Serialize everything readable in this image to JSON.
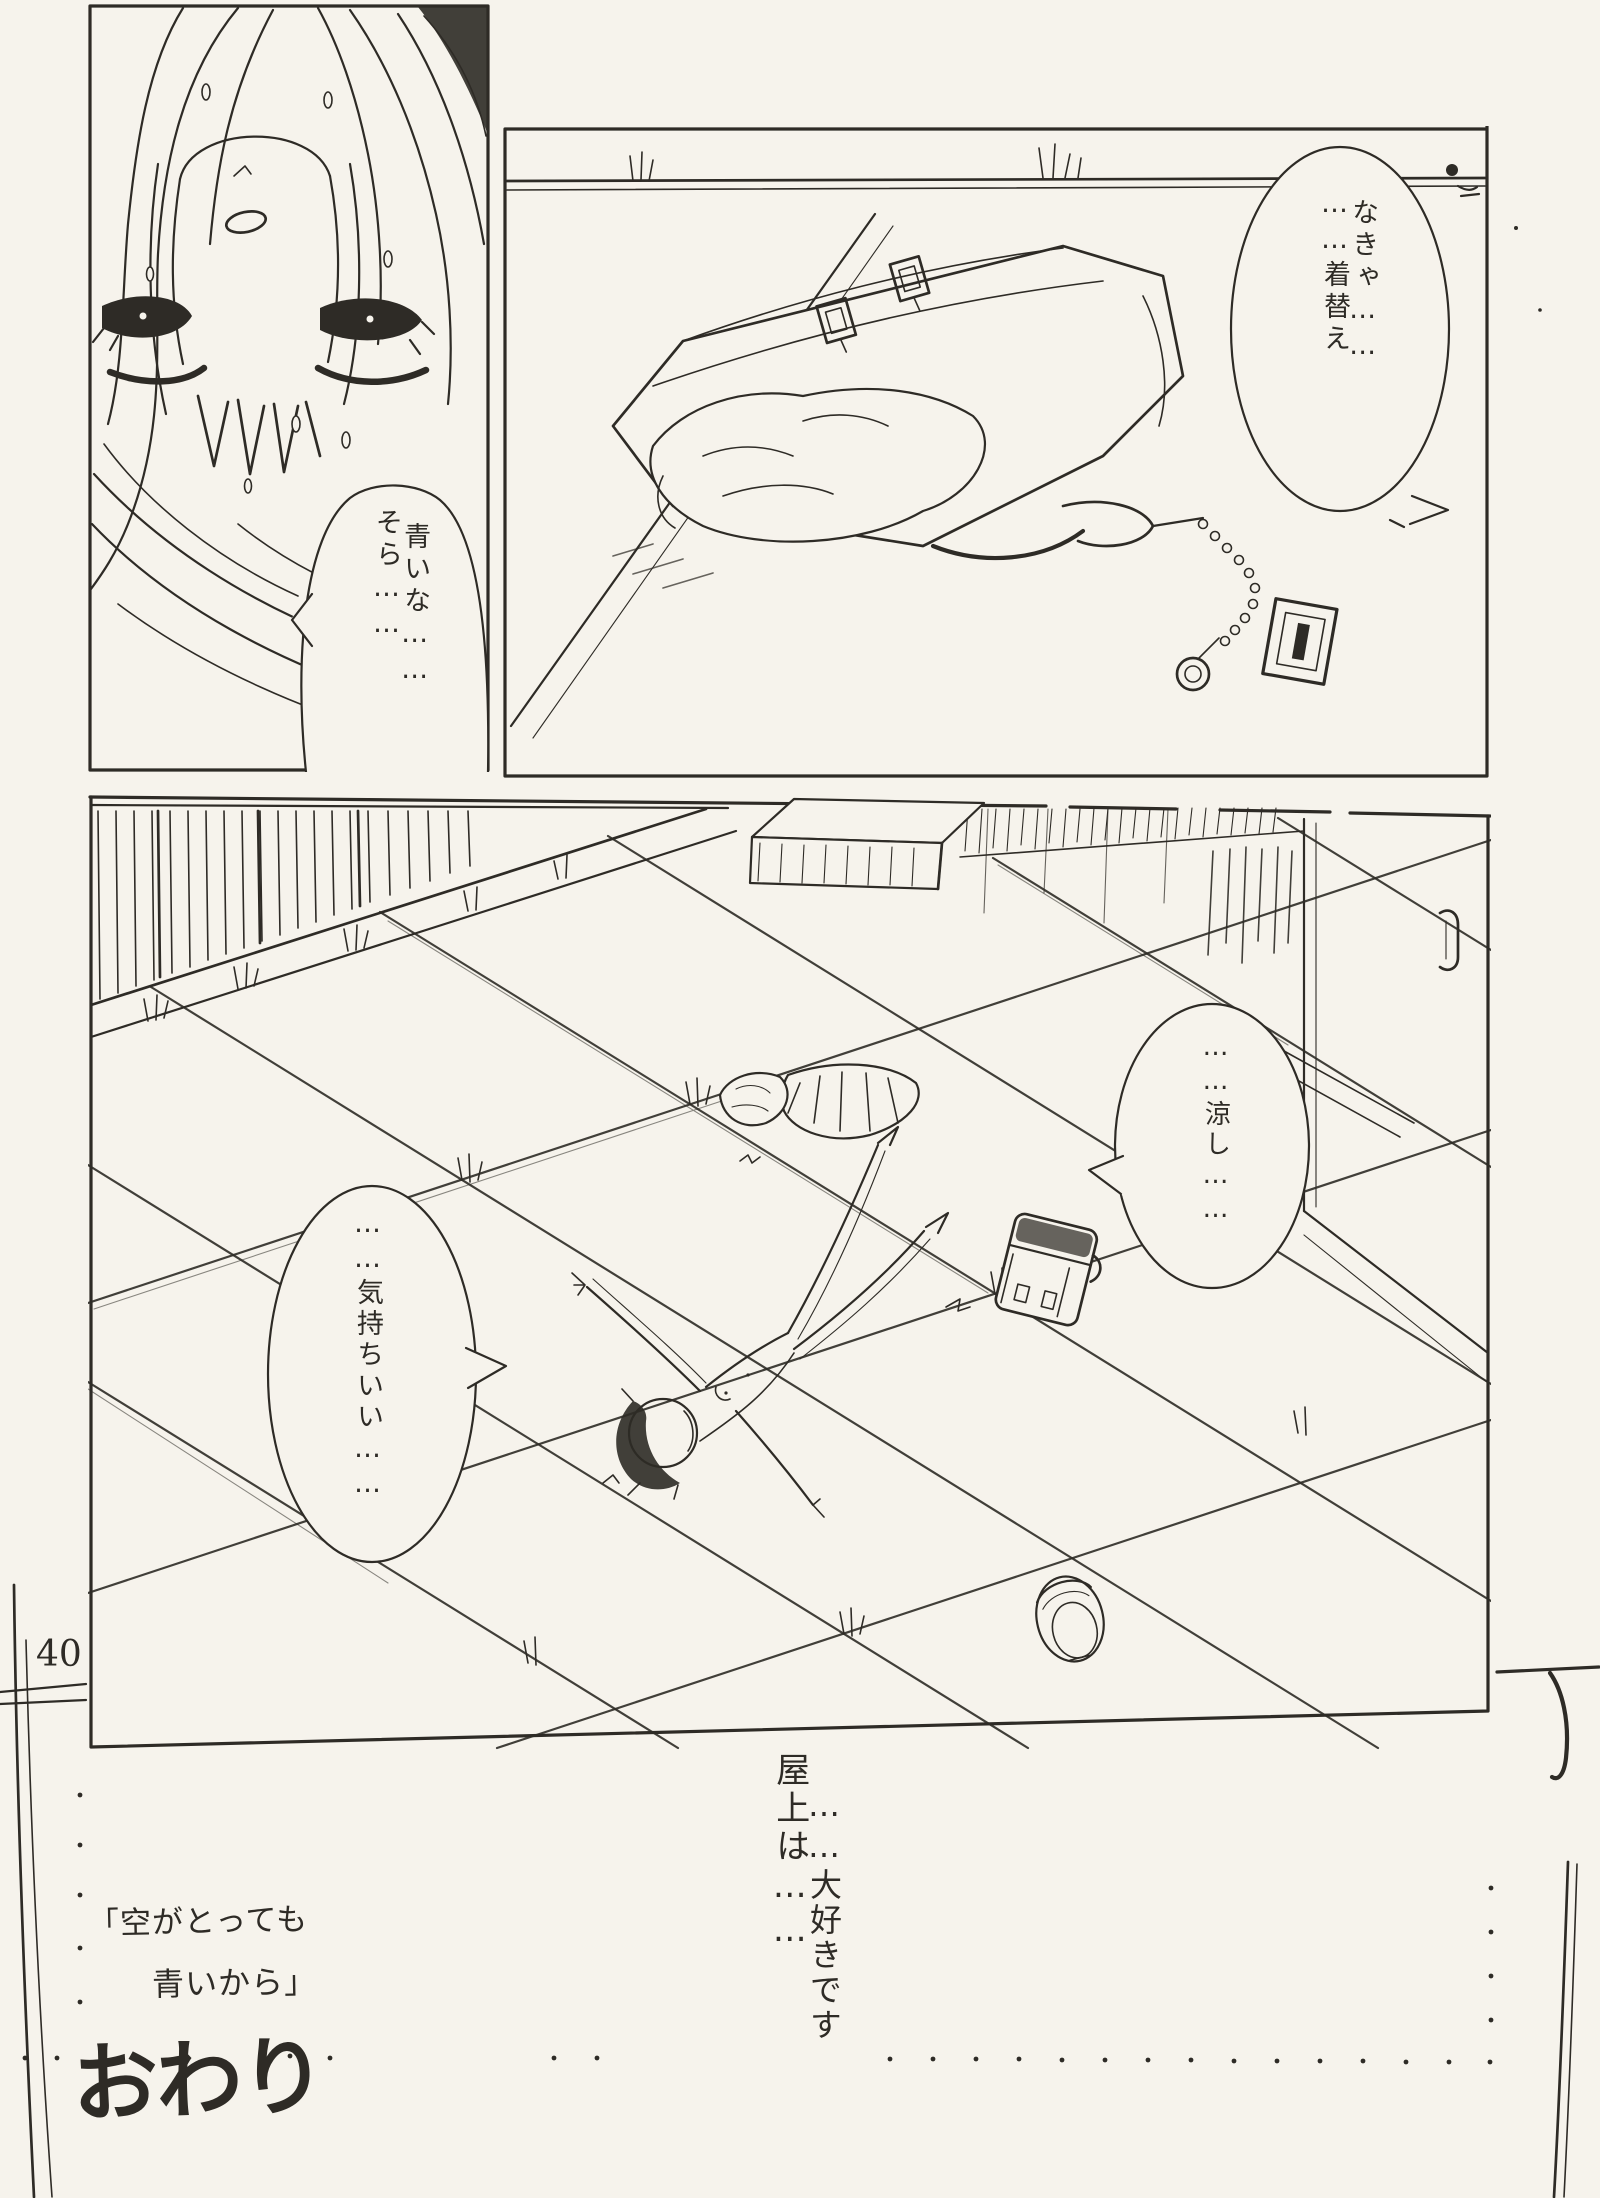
{
  "page": {
    "number": "40",
    "paper_color": "#f6f3ec",
    "ink_color": "#2e2b26"
  },
  "bubbles": {
    "sky": {
      "lines": [
        "そら……",
        "青いな……"
      ]
    },
    "change": {
      "lines": [
        "……着替え",
        "なきゃ……"
      ]
    },
    "cool": {
      "lines": [
        "……涼し……"
      ]
    },
    "feel": {
      "lines": [
        "……気持ちいい……"
      ]
    }
  },
  "captions": {
    "rooftop": {
      "lines": [
        "屋上は……",
        "……大好きです"
      ]
    },
    "title_line_1": "「空がとっても",
    "title_line_2": "青いから」",
    "end_mark": "おわり"
  }
}
